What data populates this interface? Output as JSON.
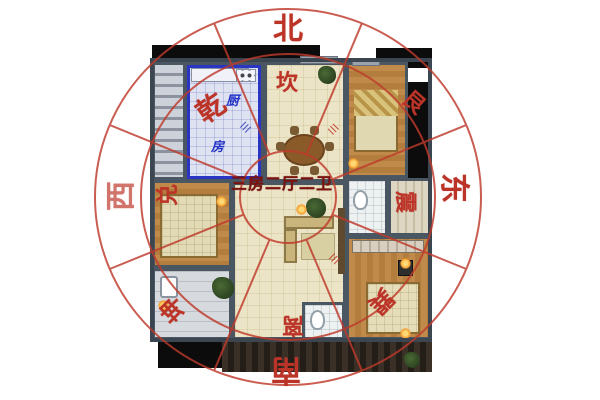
{
  "floorplan": {
    "center_label": "三房二厅二卫",
    "kitchen": {
      "label_char_1": "厨",
      "label_char_2": "房"
    }
  },
  "compass": {
    "directions": [
      {
        "id": "north",
        "label": "北"
      },
      {
        "id": "east",
        "label": "东"
      },
      {
        "id": "south",
        "label": "南"
      },
      {
        "id": "west",
        "label": "西"
      }
    ],
    "trigrams": [
      {
        "id": "kan",
        "sector": "north",
        "label": "坎"
      },
      {
        "id": "gen",
        "sector": "northeast",
        "label": "艮"
      },
      {
        "id": "zhen",
        "sector": "east",
        "label": "震"
      },
      {
        "id": "xun",
        "sector": "southeast",
        "label": "巽"
      },
      {
        "id": "li",
        "sector": "south",
        "label": "离"
      },
      {
        "id": "kun",
        "sector": "southwest",
        "label": "坤"
      },
      {
        "id": "dui",
        "sector": "west",
        "label": "兑"
      },
      {
        "id": "qian",
        "sector": "northwest",
        "label": "乾"
      }
    ],
    "trigram_symbol": "☰"
  },
  "colors": {
    "compass_red": "#bf3a2b",
    "highlight_blue": "#2a35c4",
    "center_text_red": "#7d120e",
    "kitchen_text_blue": "#2433c8",
    "wood_floor": "#bd8446",
    "cream_floor": "#ece4c6",
    "tile_floor": "#e7eaf3",
    "wall_dark": "#4a5661"
  }
}
